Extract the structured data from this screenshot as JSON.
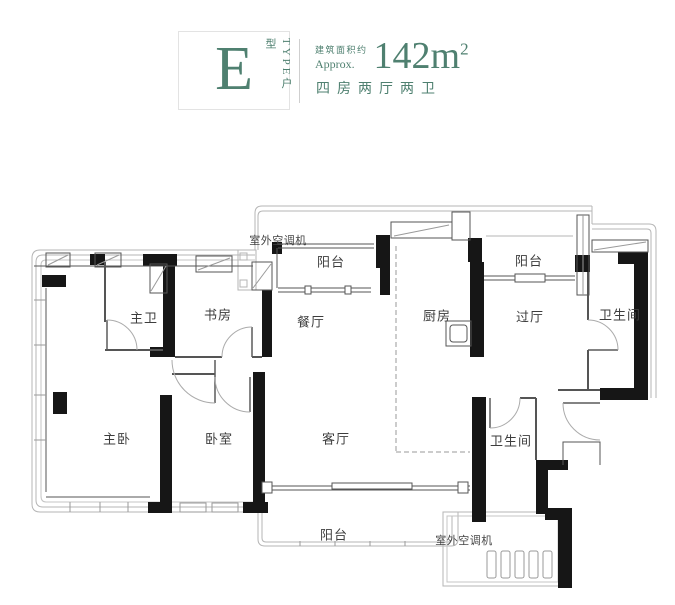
{
  "header": {
    "type_letter": "E",
    "type_side_label": "TYPE户型",
    "area_label_cn": "建筑面积约",
    "area_label_en": "Approx.",
    "area_value": "142m",
    "area_superscript": "2",
    "layout_spec": "四房两厅两卫",
    "accent_color": "#4f8070"
  },
  "floorplan": {
    "labels": {
      "ac_top": "室外空调机",
      "balcony_top_left": "阳台",
      "dining": "餐厅",
      "kitchen": "厨房",
      "hall": "过厅",
      "bath_top_right": "卫生间",
      "balcony_top_right": "阳台",
      "master_bath": "主卫",
      "study": "书房",
      "master_bedroom": "主卧",
      "bedroom": "卧室",
      "living": "客厅",
      "bath_bottom": "卫生间",
      "balcony_bottom": "阳台",
      "ac_bottom": "室外空调机"
    },
    "colors": {
      "wall": "#161616",
      "window_band": "#b5b5b5",
      "thin_wall": "#555555",
      "label_text": "#3d3d3d"
    }
  }
}
